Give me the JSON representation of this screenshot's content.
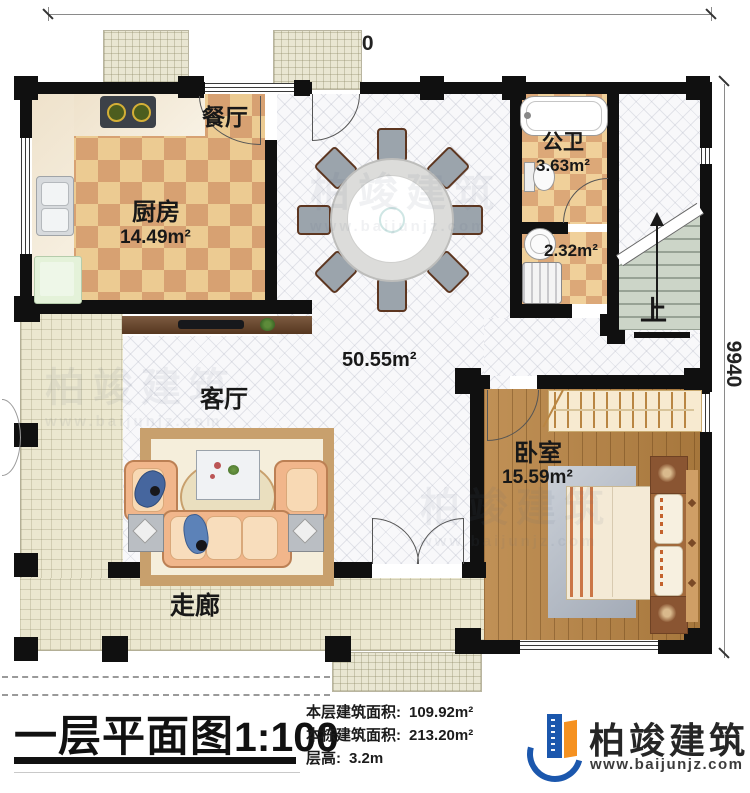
{
  "dimensions": {
    "top": "11940",
    "right": "9940"
  },
  "rooms": {
    "dining": {
      "name": "餐厅"
    },
    "kitchen": {
      "name": "厨房",
      "area": "14.49m²"
    },
    "bath": {
      "name": "公卫",
      "area": "3.63m²"
    },
    "utility": {
      "area": "2.32m²"
    },
    "hall": {
      "area": "50.55m²"
    },
    "living": {
      "name": "客厅"
    },
    "bedroom": {
      "name": "卧室",
      "area": "15.59m²"
    },
    "corridor": {
      "name": "走廊"
    },
    "stairs": {
      "label": "上"
    }
  },
  "title_block": {
    "plan_title": "一层平面图",
    "plan_scale": "1:100",
    "stats": [
      {
        "label": "本层建筑面积:",
        "value": "109.92m²"
      },
      {
        "label": "本栋建筑面积:",
        "value": "213.20m²"
      },
      {
        "label": "层高:",
        "value": "3.2m"
      }
    ],
    "brand": {
      "name": "柏竣建筑",
      "website": "www.baijunjz.com"
    }
  },
  "watermark": {
    "name": "柏竣建筑",
    "website": "www.baijunjz.com"
  },
  "colors": {
    "wall": "#101010",
    "brand_blue": "#1b57ad",
    "brand_orange": "#f59120",
    "checker_light": "#eccb92",
    "checker_dark": "#d7a172"
  }
}
